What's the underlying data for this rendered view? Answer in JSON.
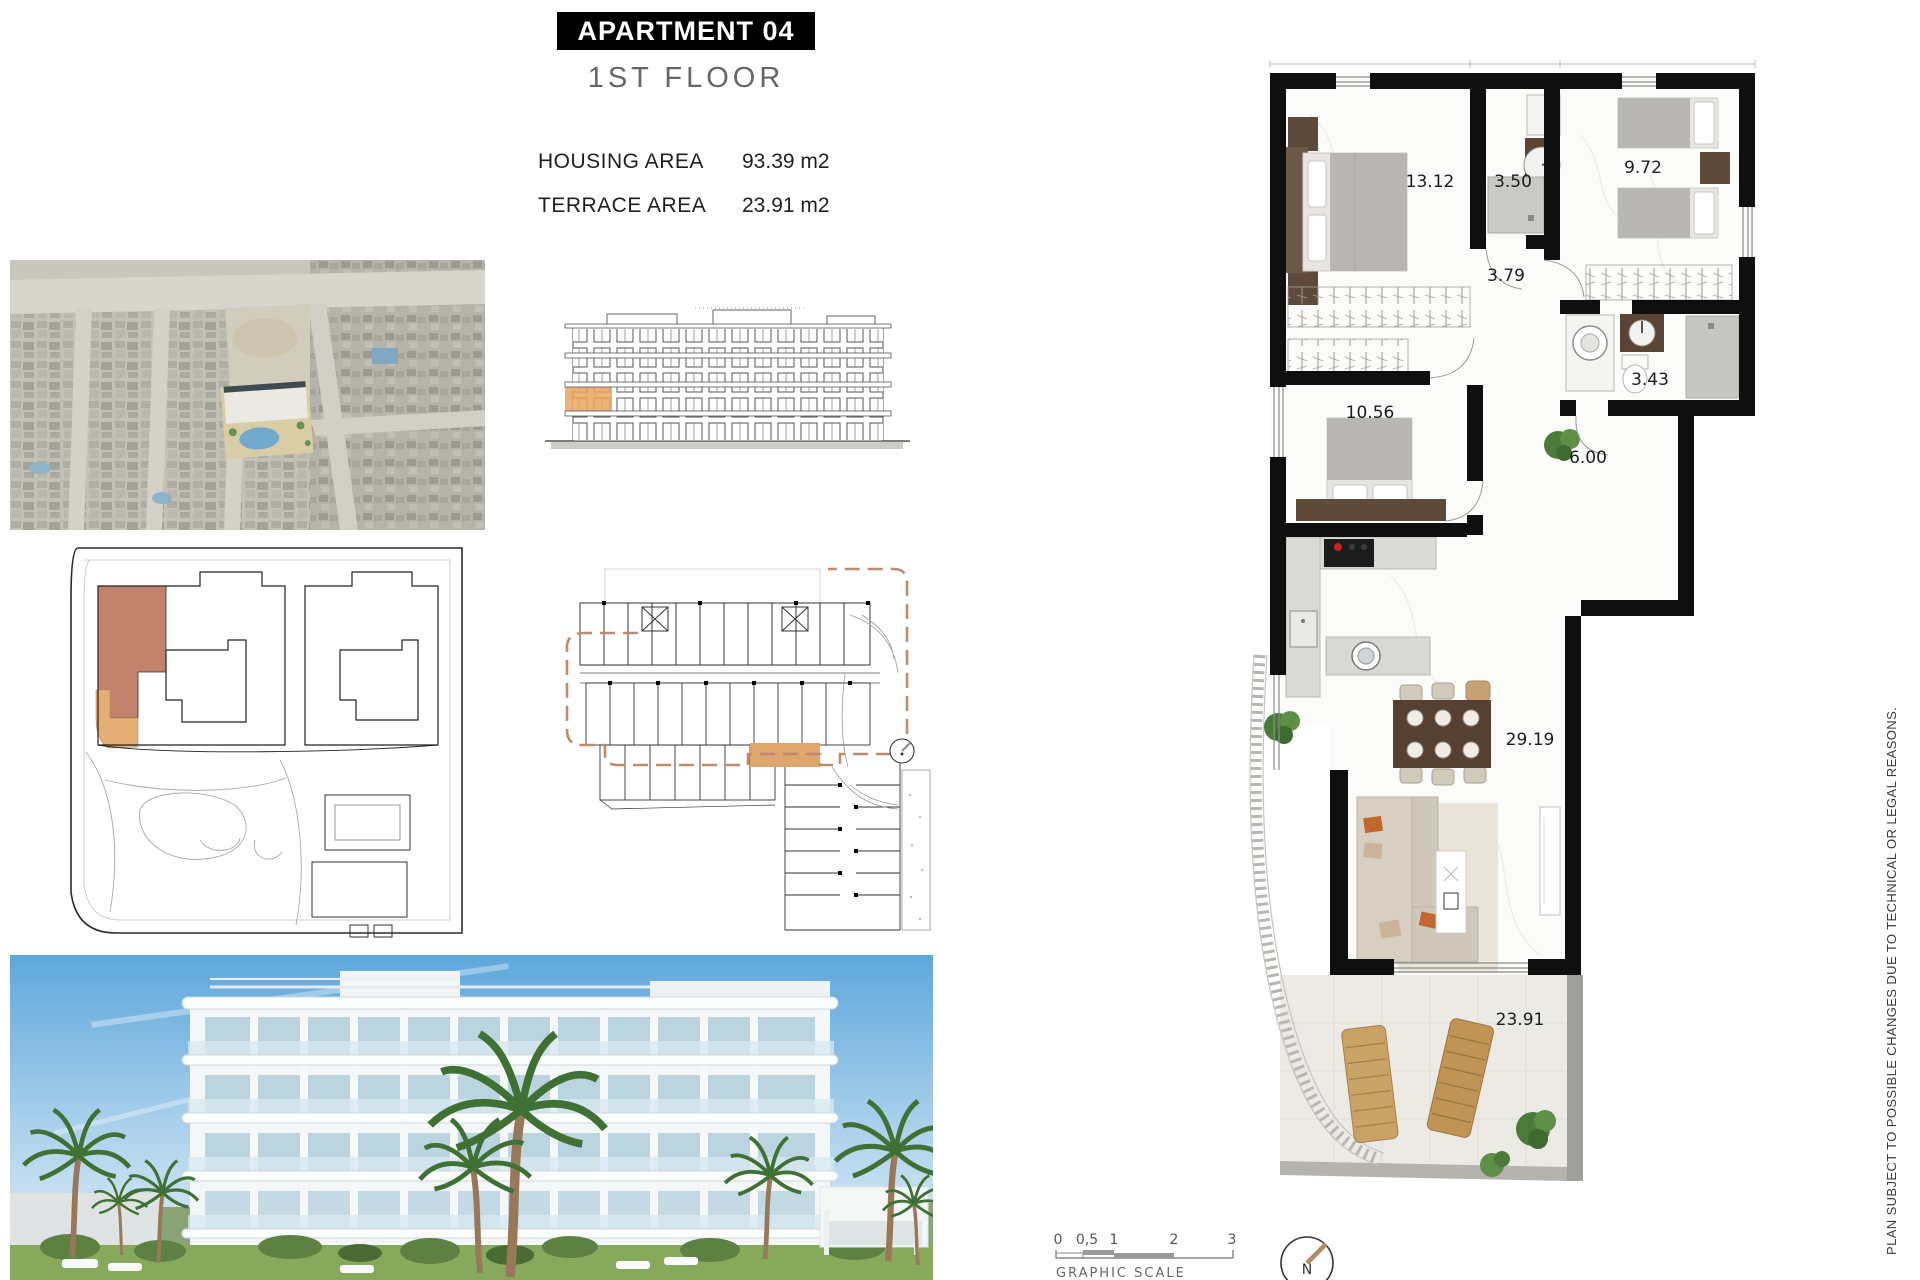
{
  "sheet": {
    "title": "APARTMENT 04",
    "subtitle": "1ST FLOOR",
    "areas": {
      "housing": {
        "label": "HOUSING AREA",
        "value": "93.39 m2"
      },
      "terrace": {
        "label": "TERRACE AREA",
        "value": "23.91 m2"
      }
    }
  },
  "floor_plan": {
    "room_measurements": {
      "master_bedroom": "13.12",
      "bathroom_1": "3.50",
      "bedroom_2": "9.72",
      "hallway": "3.79",
      "bathroom_2": "3.43",
      "bedroom_3": "10.56",
      "corridor": "6.00",
      "living_dining": "29.19",
      "terrace": "23.91"
    }
  },
  "scale_bar": {
    "ticks": [
      "0",
      "0,5",
      "1",
      "2",
      "3"
    ],
    "label": "GRAPHIC SCALE"
  },
  "compass": {
    "label": "N"
  },
  "disclaimer": "PLAN SUBJECT TO POSSIBLE CHANGES DUE TO TECHNICAL OR LEGAL REASONS.",
  "colors": {
    "wall": "#111111",
    "highlight_rose": "#c2826b",
    "highlight_tan": "#e4af74",
    "highlight_orange": "#e9a660",
    "key_plan_dash": "#bd8b6e",
    "compass_needle": "#b08968",
    "pool_blue": "#72aacd"
  }
}
